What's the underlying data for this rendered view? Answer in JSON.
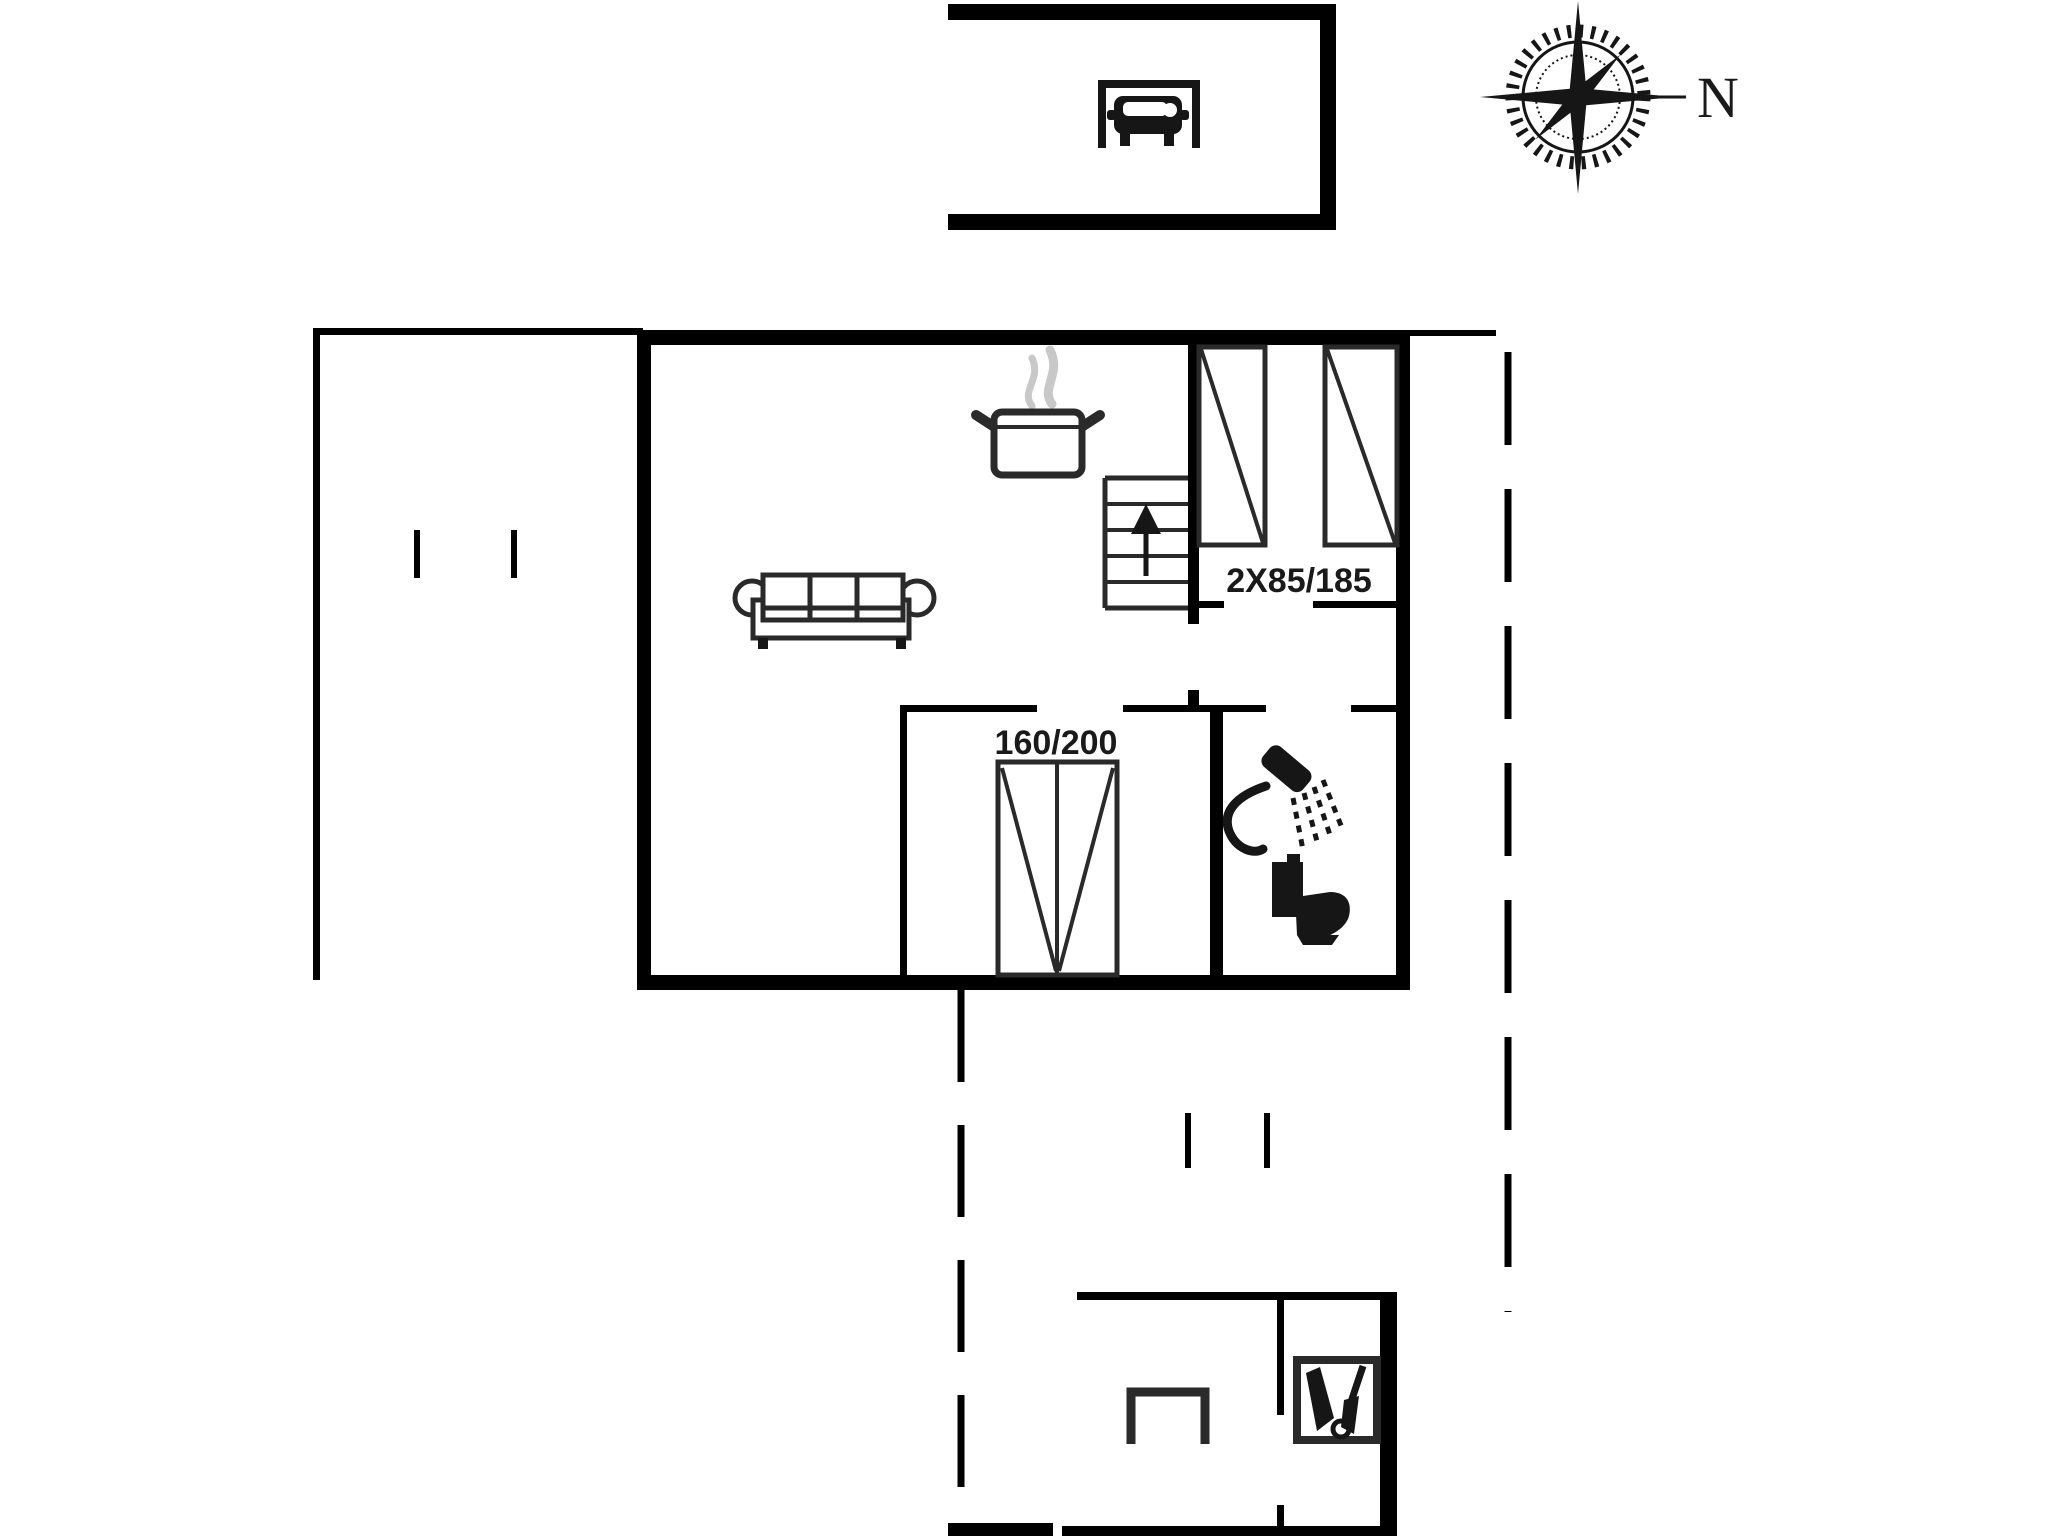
{
  "plan_type": "floor-plan",
  "compass": {
    "label": "N"
  },
  "labels": {
    "twin_beds": "2X85/185",
    "double_bed": "160/200"
  },
  "colors": {
    "background": "#ffffff",
    "wall": "#000000",
    "furniture": "#2a2a2a",
    "icon": "#161616",
    "steam": "#c8c8c8",
    "text": "#1a1a1a"
  },
  "icons": {
    "garage": "car-icon",
    "orientation": "compass-rose-icon",
    "kitchen": "cooking-pot-icon",
    "living": "sofa-icon",
    "stairs": "stairs-up-arrow-icon",
    "bathroom_shower": "shower-icon",
    "bathroom_wc": "toilet-icon",
    "outbuilding": "garden-tools-icon",
    "outbuilding_table": "table-icon"
  }
}
